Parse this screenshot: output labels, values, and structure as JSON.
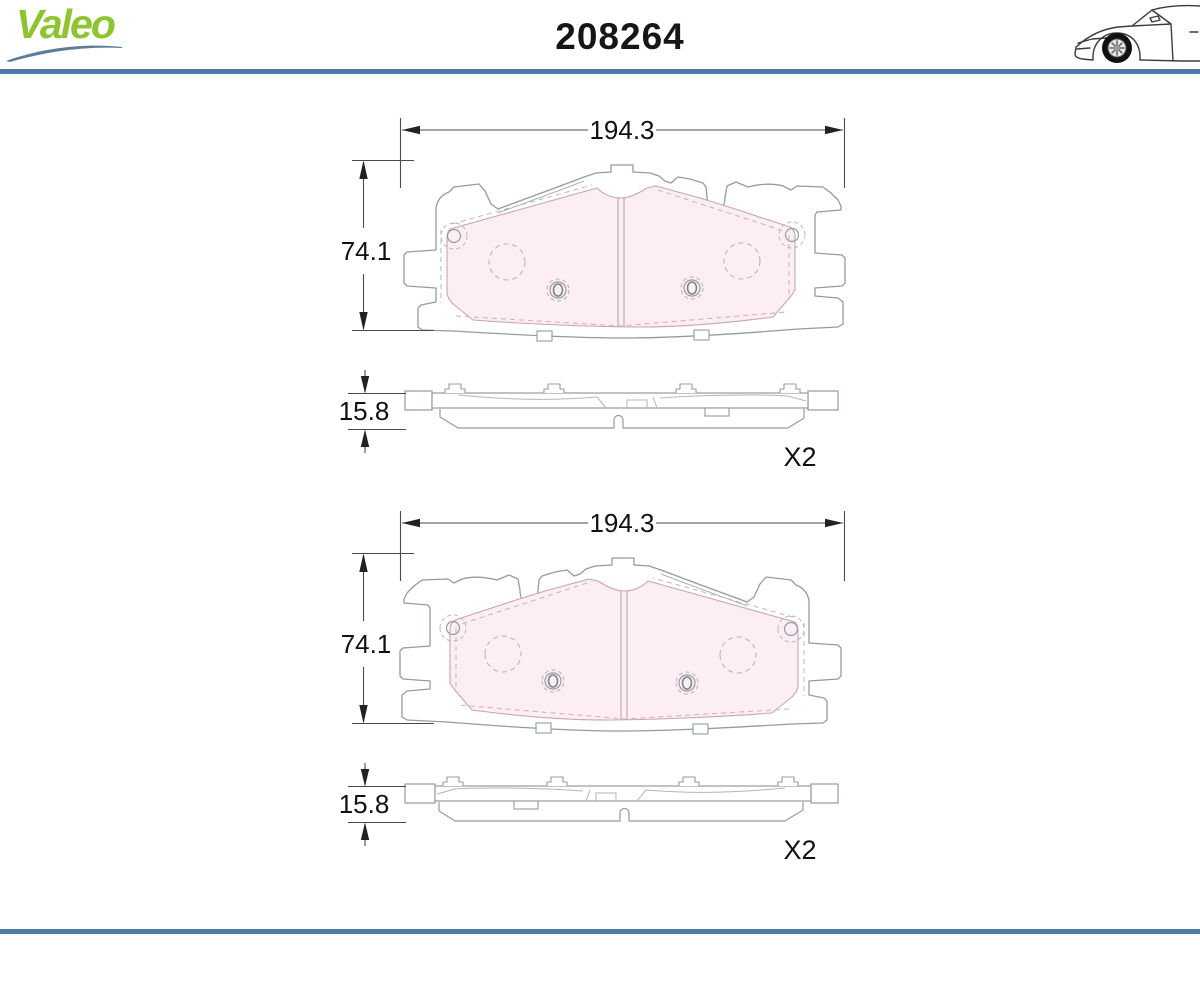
{
  "header": {
    "brand": "Valeo",
    "part_number": "208264"
  },
  "drawings": [
    {
      "front": {
        "width_label": "194.3",
        "height_label": "74.1"
      },
      "side": {
        "thickness_label": "15.8"
      },
      "quantity_label": "X2"
    },
    {
      "front": {
        "width_label": "194.3",
        "height_label": "74.1"
      },
      "side": {
        "thickness_label": "15.8"
      },
      "quantity_label": "X2"
    }
  ],
  "icons": {
    "logo_swoosh": "swoosh-icon",
    "car": "car-side-icon"
  },
  "colors": {
    "rule_blue": "#4d7ba7",
    "brand_green": "#8ec431",
    "swoosh_blue": "#5b7c98",
    "pad_fill_pink": "#fceef2",
    "line_gray": "#949ba3",
    "dim_color": "#1a1a1a"
  }
}
